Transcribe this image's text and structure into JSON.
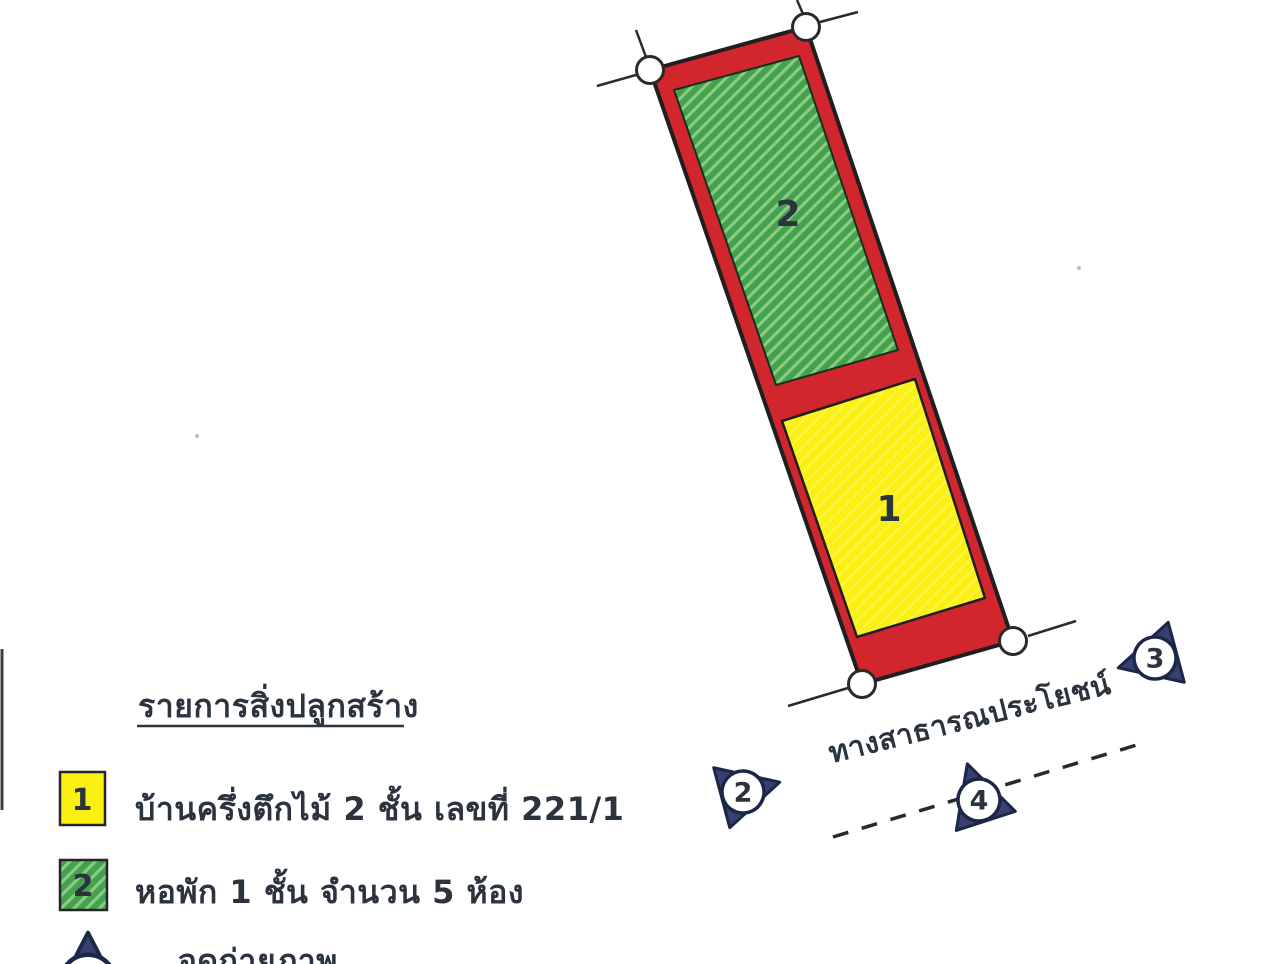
{
  "plan": {
    "road_label": "ทางสาธารณประโยชน์",
    "photo_points": [
      {
        "number": "2"
      },
      {
        "number": "3"
      },
      {
        "number": "4"
      }
    ]
  },
  "buildings": [
    {
      "number": "1",
      "name": "บ้านครึ่งตึกไม้ 2 ชั้น เลขที่ 221/1",
      "color": "#FAF011"
    },
    {
      "number": "2",
      "name": "หอพัก 1 ชั้น จำนวน 5 ห้อง",
      "color": "#44A24E"
    }
  ],
  "legend": {
    "title": "รายการสิ่งปลูกสร้าง",
    "photo_point_label": "จุดถ่ายภาพ"
  },
  "colors": {
    "background": "#FFFFFF",
    "parcel_red": "#D2262E",
    "marker_navy": "#39406F",
    "ink": "#1F1F1F"
  }
}
